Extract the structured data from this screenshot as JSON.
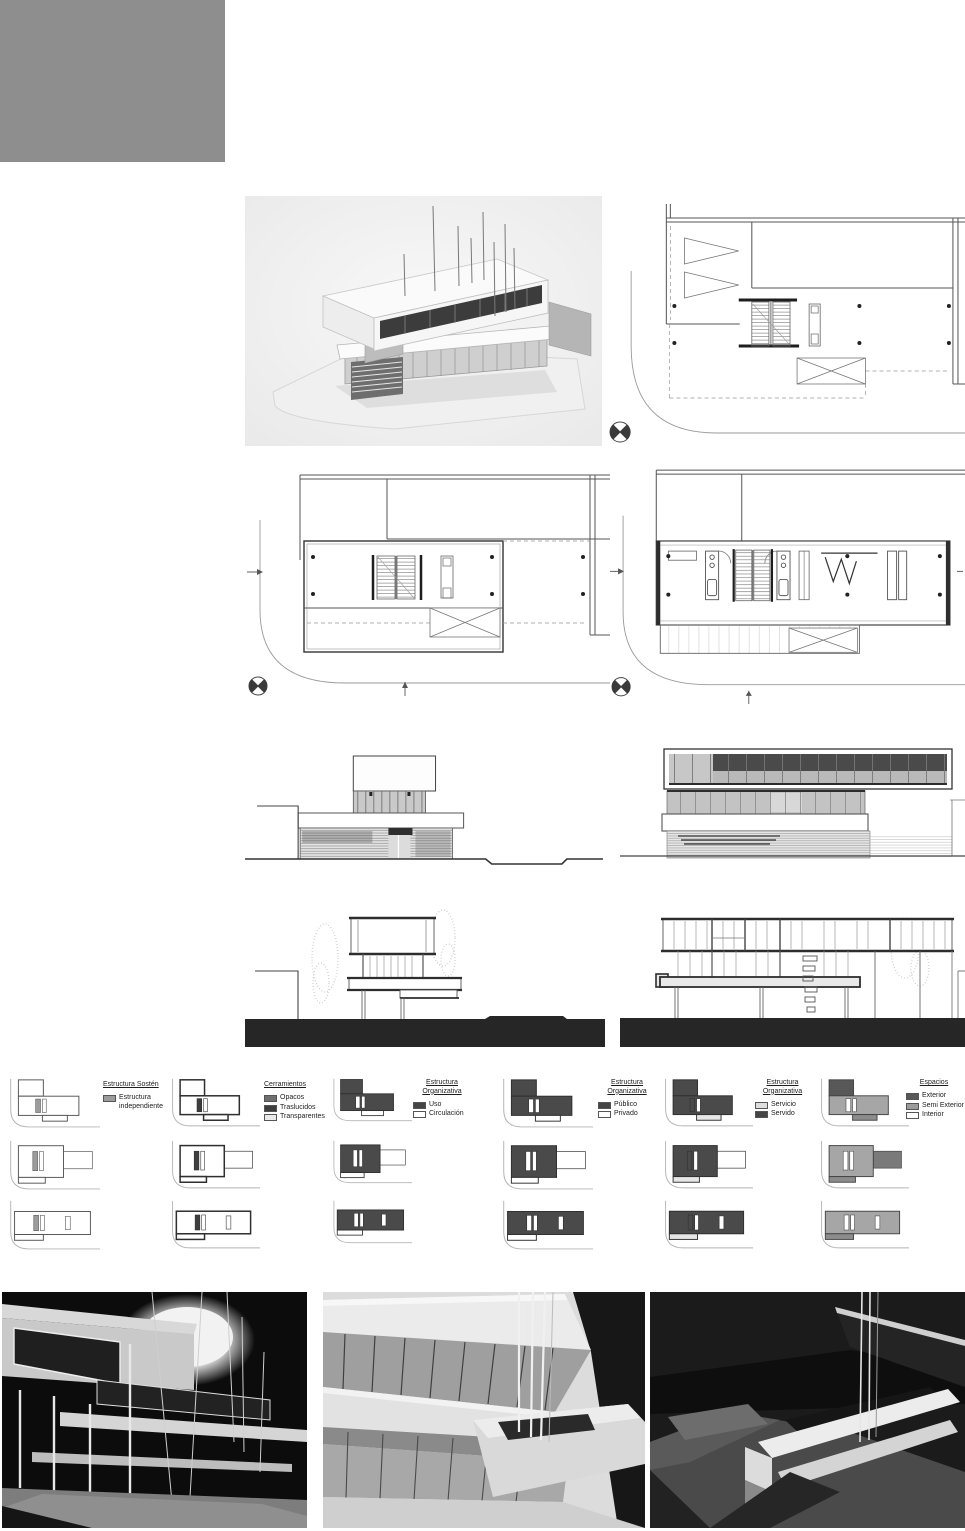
{
  "colors": {
    "page_background": "#ffffff",
    "cover_block": "#8e8e8e",
    "drawing_line": "#4a4a4a",
    "dark_band": "#3c3c3c",
    "section_ground": "#262626",
    "photo_dark_background": "#101010"
  },
  "legends": [
    {
      "title": "Estructura Sostén",
      "items": [
        {
          "label": "Estructura independiente",
          "swatch": "#9c9c9c"
        }
      ]
    },
    {
      "title": "Cerramientos",
      "items": [
        {
          "label": "Opacos",
          "swatch": "#6f6f6f"
        },
        {
          "label": "Traslucidos",
          "swatch": "#3e3e3e"
        },
        {
          "label": "Transparentes",
          "swatch": "#eaeaea"
        }
      ]
    },
    {
      "title": "Estructura Organizativa",
      "items": [
        {
          "label": "Uso",
          "swatch": "#454545"
        },
        {
          "label": "Circulación",
          "swatch": "#ffffff"
        }
      ]
    },
    {
      "title": "Estructura Organizativa",
      "items": [
        {
          "label": "Público",
          "swatch": "#454545"
        },
        {
          "label": "Privado",
          "swatch": "#ffffff"
        }
      ]
    },
    {
      "title": "Estructura Organizativa",
      "items": [
        {
          "label": "Servicio",
          "swatch": "#dedede"
        },
        {
          "label": "Servido",
          "swatch": "#454545"
        }
      ]
    },
    {
      "title": "Espacios",
      "items": [
        {
          "label": "Exterior",
          "swatch": "#585858"
        },
        {
          "label": "Semi Exterior",
          "swatch": "#9b9b9b"
        },
        {
          "label": "Interior",
          "swatch": "#ffffff"
        }
      ]
    }
  ],
  "diagram_strip": {
    "columns": [
      "sosten",
      "cerramientos",
      "uso",
      "publico",
      "servicio",
      "espacios"
    ],
    "themes": {
      "sosten": {
        "A": "#ffffff",
        "B": "#ffffff",
        "C": "#ffffff",
        "core": "#9c9c9c",
        "stroke": "#555555",
        "wall": 1,
        "ext": "#ffffff"
      },
      "cerramientos": {
        "A": "#ffffff",
        "B": "#ffffff",
        "C": "#ffffff",
        "core": "#3e3e3e",
        "stroke": "#2f2f2f",
        "wall": 1.6,
        "ext": "#ffffff"
      },
      "uso": {
        "A": "#4a4a4a",
        "B": "#4a4a4a",
        "C": "#ffffff",
        "core": "#ffffff",
        "stroke": "#2f2f2f",
        "wall": 1,
        "ext": "#ffffff"
      },
      "publico": {
        "A": "#4a4a4a",
        "B": "#4a4a4a",
        "C": "#ffffff",
        "core": "#ffffff",
        "stroke": "#2f2f2f",
        "wall": 1,
        "ext": "#ffffff"
      },
      "servicio": {
        "A": "#4a4a4a",
        "B": "#4a4a4a",
        "C": "#e6e6e6",
        "core": "#4a4a4a",
        "stroke": "#2f2f2f",
        "wall": 1,
        "ext": "#ffffff"
      },
      "espacios": {
        "A": "#585858",
        "B": "#a6a6a6",
        "C": "#8c8c8c",
        "core": "#ffffff",
        "stroke": "#444444",
        "wall": 1,
        "ext": "#7a7a7a"
      }
    }
  }
}
